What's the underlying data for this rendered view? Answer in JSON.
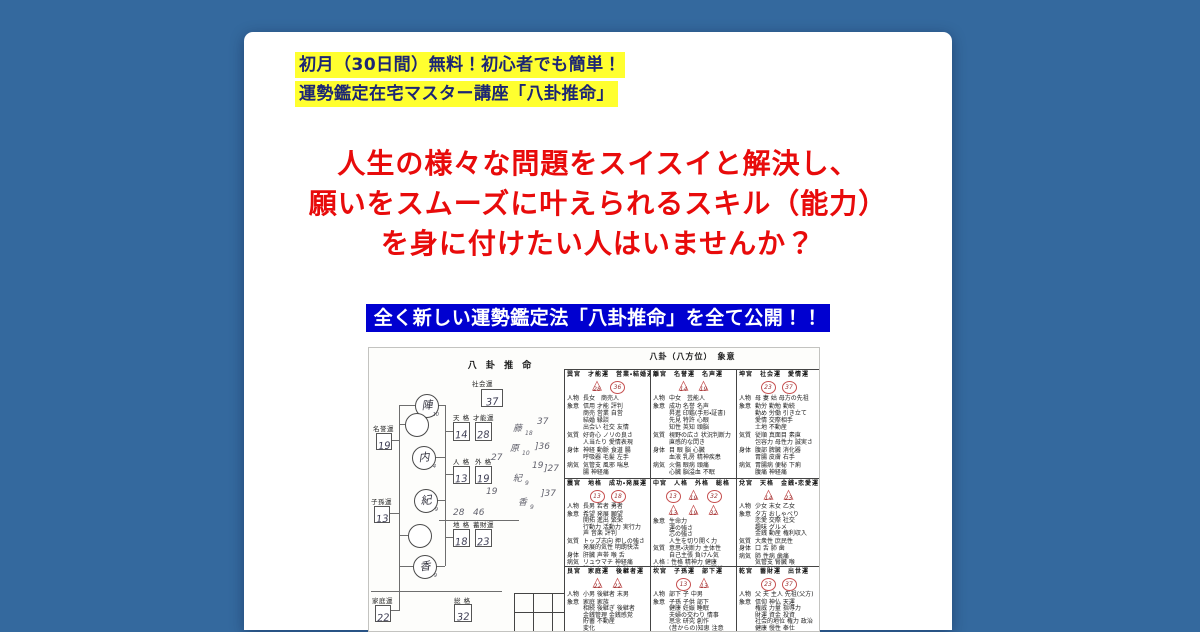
{
  "canvas": {
    "bg": "#34699e",
    "card_bg": "#ffffff"
  },
  "promo": {
    "bg": "#ffff2f",
    "color": "#1c2674",
    "lines": [
      "初月（30日間）無料！初心者でも簡単！",
      "運勢鑑定在宅マスター講座「八卦推命」"
    ]
  },
  "headline": {
    "color": "#e80b0b",
    "lines": [
      "人生の様々な問題をスイスイと解決し、",
      "願いをスムーズに叶えられるスキル（能力）",
      "を身に付けたい人はいませんか？"
    ]
  },
  "banner": {
    "bg": "#0000d0",
    "color": "#ffffff",
    "text": "全く新しい運勢鑑定法「八卦推命」を全て公開！！"
  },
  "scan": {
    "diagram": {
      "title": "八 卦 推 命",
      "circles": [
        {
          "char": "陣",
          "strokes": "10",
          "x": 46,
          "y": 46
        },
        {
          "char": "",
          "strokes": "",
          "x": 36,
          "y": 65
        },
        {
          "char": "内",
          "strokes": "4",
          "x": 43,
          "y": 98
        },
        {
          "char": "紀",
          "strokes": "9",
          "x": 45,
          "y": 141
        },
        {
          "char": "",
          "strokes": "",
          "x": 39,
          "y": 176
        },
        {
          "char": "香",
          "strokes": "9",
          "x": 44,
          "y": 207
        }
      ],
      "scores": [
        {
          "label": "社会運",
          "value": "37",
          "lx": 103,
          "ly": 30,
          "bx": 112,
          "by": 41,
          "bw": 20,
          "bh": 16
        },
        {
          "label": "天 格",
          "value": "14",
          "lx": 84,
          "ly": 64,
          "bx": 84,
          "by": 74,
          "bw": 15,
          "bh": 17
        },
        {
          "label": "才能運",
          "value": "28",
          "lx": 104,
          "ly": 64,
          "bx": 106,
          "by": 74,
          "bw": 15,
          "bh": 17
        },
        {
          "label": "名誉運",
          "value": "19",
          "lx": 4,
          "ly": 75,
          "bx": 7,
          "by": 85,
          "bw": 14,
          "bh": 15
        },
        {
          "label": "人 格",
          "value": "13",
          "lx": 84,
          "ly": 108,
          "bx": 84,
          "by": 118,
          "bw": 15,
          "bh": 16
        },
        {
          "label": "外 格",
          "value": "19",
          "lx": 106,
          "ly": 108,
          "bx": 106,
          "by": 118,
          "bw": 15,
          "bh": 16
        },
        {
          "label": "子孫運",
          "value": "13",
          "lx": 2,
          "ly": 148,
          "bx": 5,
          "by": 158,
          "bw": 14,
          "bh": 15
        },
        {
          "label": "地 格",
          "value": "18",
          "lx": 84,
          "ly": 171,
          "bx": 84,
          "by": 181,
          "bw": 15,
          "bh": 16
        },
        {
          "label": "蓄財運",
          "value": "23",
          "lx": 104,
          "ly": 171,
          "bx": 106,
          "by": 181,
          "bw": 15,
          "bh": 16
        },
        {
          "label": "家庭運",
          "value": "22",
          "lx": 3,
          "ly": 247,
          "bx": 6,
          "by": 257,
          "bw": 14,
          "bh": 15
        },
        {
          "label": "総 格",
          "value": "32",
          "lx": 85,
          "ly": 247,
          "bx": 85,
          "by": 256,
          "bw": 16,
          "bh": 16
        }
      ],
      "lines": [
        {
          "x": 30,
          "y": 57,
          "w": 1,
          "h": 162
        },
        {
          "x": 30,
          "y": 57,
          "w": 16,
          "h": 1
        },
        {
          "x": 30,
          "y": 76,
          "w": 6,
          "h": 1
        },
        {
          "x": 30,
          "y": 187,
          "w": 9,
          "h": 1
        },
        {
          "x": 30,
          "y": 218,
          "w": 14,
          "h": 1
        },
        {
          "x": 21,
          "y": 92,
          "w": 9,
          "h": 1
        },
        {
          "x": 19,
          "y": 165,
          "w": 11,
          "h": 1
        },
        {
          "x": 30,
          "y": 218,
          "w": 1,
          "h": 45
        },
        {
          "x": 20,
          "y": 262,
          "w": 10,
          "h": 1
        },
        {
          "x": 76,
          "y": 57,
          "w": 1,
          "h": 161
        },
        {
          "x": 68,
          "y": 57,
          "w": 8,
          "h": 1
        },
        {
          "x": 66,
          "y": 109,
          "w": 10,
          "h": 1
        },
        {
          "x": 67,
          "y": 152,
          "w": 9,
          "h": 1
        },
        {
          "x": 66,
          "y": 218,
          "w": 10,
          "h": 1
        },
        {
          "x": 76,
          "y": 83,
          "w": 8,
          "h": 1
        },
        {
          "x": 76,
          "y": 126,
          "w": 8,
          "h": 1
        },
        {
          "x": 76,
          "y": 189,
          "w": 8,
          "h": 1
        },
        {
          "x": 2,
          "y": 243,
          "w": 131,
          "h": 1
        },
        {
          "x": 70,
          "y": 172,
          "w": 80,
          "h": 1
        }
      ],
      "handnote": [
        {
          "t": "37",
          "x": 168,
          "y": 70
        },
        {
          "t": "藤",
          "x": 144,
          "y": 77
        },
        {
          "t": "18",
          "x": 156,
          "y": 83,
          "s": 1
        },
        {
          "t": "]36",
          "x": 166,
          "y": 95
        },
        {
          "t": "原",
          "x": 141,
          "y": 97
        },
        {
          "t": "10",
          "x": 153,
          "y": 103,
          "s": 1
        },
        {
          "t": "27",
          "x": 122,
          "y": 106
        },
        {
          "t": "19",
          "x": 163,
          "y": 114
        },
        {
          "t": "]27",
          "x": 175,
          "y": 117
        },
        {
          "t": "紀",
          "x": 144,
          "y": 127
        },
        {
          "t": "9",
          "x": 156,
          "y": 133,
          "s": 1
        },
        {
          "t": "19",
          "x": 117,
          "y": 140
        },
        {
          "t": "]37",
          "x": 172,
          "y": 142
        },
        {
          "t": "香",
          "x": 149,
          "y": 151
        },
        {
          "t": "9",
          "x": 161,
          "y": 157,
          "s": 1
        },
        {
          "t": "28",
          "x": 84,
          "y": 161
        },
        {
          "t": "46",
          "x": 104,
          "y": 161
        }
      ],
      "grid": {
        "x": 145,
        "y": 245,
        "cell": 19,
        "rows": 3,
        "cols": 3
      }
    },
    "table": {
      "title": "八卦（八方位）　象意",
      "row_heights": [
        108,
        87,
        90
      ],
      "col_widths": [
        85,
        86,
        84
      ],
      "rows": [
        [
          {
            "palace": "巽宮",
            "fortunes": "才能運　営業・結婚運",
            "marks": [
              {
                "shape": "tri",
                "n": "28"
              },
              {
                "shape": "circ",
                "n": "36"
              }
            ],
            "entries": [
              {
                "label": "人物",
                "text": "長女　商売人"
              },
              {
                "label": "象意",
                "text": "信用 才能 評判\n商売 営業 自営\n結婚 縁談\n出会い 社交 友情"
              },
              {
                "label": "気質",
                "text": "好奇心 ノリの良さ\n人当たり 愛情表現"
              },
              {
                "label": "身体",
                "text": "神経 動脈 食道 腸\n呼吸器 毛髪 左手"
              },
              {
                "label": "病気",
                "text": "気管支 風邪 喘息\n腸 神経痛"
              }
            ]
          },
          {
            "palace": "離宮",
            "fortunes": "名誉運　名声運",
            "marks": [
              {
                "shape": "tri",
                "n": "14"
              },
              {
                "shape": "tri",
                "n": "19"
              }
            ],
            "entries": [
              {
                "label": "人物",
                "text": "中女　芸能人"
              },
              {
                "label": "象意",
                "text": "成功 名誉 名声\n昇進 印鑑(手形・証書)\n先見 特許 心眼\n知性 英知 頭脳"
              },
              {
                "label": "気質",
                "text": "視野の広さ 状況判断力\n直感的な閃き"
              },
              {
                "label": "身体",
                "text": "目 眼 脳 心臓\n血液 乳房 精神疾患"
              },
              {
                "label": "病気",
                "text": "火傷 眼病 頭痛\n心臓 脳溢血 不眠"
              }
            ]
          },
          {
            "palace": "坤宮",
            "fortunes": "社会運　愛情運",
            "marks": [
              {
                "shape": "circ",
                "n": "23"
              },
              {
                "shape": "circ",
                "n": "37"
              }
            ],
            "entries": [
              {
                "label": "人物",
                "text": "母 妻 姑 母方の先祖"
              },
              {
                "label": "象意",
                "text": "勤労 勤勉 勤続\n勤め 労働 引き立て\n愛情 交際相手\n土地 不動産"
              },
              {
                "label": "気質",
                "text": "従順 真面目 素直\n包容力 母性力 誠実さ"
              },
              {
                "label": "身体",
                "text": "腹部 脾臓 消化器\n胃腸 皮膚 右手"
              },
              {
                "label": "病気",
                "text": "胃腸病 便秘 下痢\n腹痛 神経痛"
              }
            ]
          }
        ],
        [
          {
            "palace": "震宮",
            "fortunes": "地格　成功・発展運",
            "marks": [
              {
                "shape": "circ",
                "n": "13"
              },
              {
                "shape": "circ",
                "n": "18"
              }
            ],
            "entries": [
              {
                "label": "人物",
                "text": "長男 若者 勇者"
              },
              {
                "label": "象意",
                "text": "希望 発展 願望\n開拓 進出 繁栄\n行動力 活動力 実行力\n声 音楽 評判"
              },
              {
                "label": "気質",
                "text": "トップ志向 押しの強さ\n発展的気性 明朗快活"
              },
              {
                "label": "身体",
                "text": "肝臓 声帯 喉 舌"
              },
              {
                "label": "病気",
                "text": "リュウマチ 神経痛\n脱毛 高血圧 肝臓"
              }
            ]
          },
          {
            "palace": "中宮",
            "fortunes": "人格　外格　総格",
            "narrow": true,
            "marks": [
              {
                "shape": "circ",
                "n": "13"
              },
              {
                "shape": "tri",
                "n": "19"
              },
              {
                "shape": "circ",
                "n": "32"
              },
              {
                "shape": "tri",
                "n": "13"
              },
              {
                "shape": "tri",
                "n": "19"
              },
              {
                "shape": "tri",
                "n": "32"
              }
            ],
            "entries": [
              {
                "label": "象意",
                "text": "生命力\n運の強さ\n芯の強さ\n人生を切り開く力"
              },
              {
                "label": "気質",
                "text": "意思・決断力 主体性\n自己主張 負けん気"
              },
              {
                "label": "",
                "text": "人格：性格 精神力 健康\n外格：外見 印象 対人関係\n総格：頑張る力 生命力"
              }
            ]
          },
          {
            "palace": "兌宮",
            "fortunes": "天格　金銭・恋愛運",
            "marks": [
              {
                "shape": "tri",
                "n": "14"
              },
              {
                "shape": "tri",
                "n": "23"
              }
            ],
            "entries": [
              {
                "label": "人物",
                "text": "少女 末女 乙女"
              },
              {
                "label": "象意",
                "text": "夕方 おしゃべり\n恋愛 交際 社交\n趣味 グルメ\n金銭 動産 権利収入"
              },
              {
                "label": "気質",
                "text": "大衆性 庶民性"
              },
              {
                "label": "身体",
                "text": "口 舌 肺 歯"
              },
              {
                "label": "病気",
                "text": "肺 性病 歯痛\n気管支 腎臓 喉"
              }
            ]
          }
        ],
        [
          {
            "palace": "艮宮",
            "fortunes": "家庭運　後継者運",
            "marks": [
              {
                "shape": "tri",
                "n": "22"
              },
              {
                "shape": "tri",
                "n": "22"
              }
            ],
            "entries": [
              {
                "label": "人物",
                "text": "小男 後継者 末男"
              },
              {
                "label": "象意",
                "text": "家庭 家族\n相続 後継ぎ 後継者\n金銭管理 金銭感覚\n貯蓄 不動産\n変化"
              },
              {
                "label": "気質",
                "text": "家庭・身内に対する愛情"
              }
            ]
          },
          {
            "palace": "坎宮",
            "fortunes": "子孫運　部下運",
            "marks": [
              {
                "shape": "circ",
                "n": "13"
              },
              {
                "shape": "tri",
                "n": "13"
              }
            ],
            "entries": [
              {
                "label": "人物",
                "text": "部下 子 中男"
              },
              {
                "label": "象意",
                "text": "子孫 子供 部下\n健康 妊娠 睡眠\n夫婦の交わり 情事\n思念 研究 創作\n(昔からの)知恵 注意"
              },
              {
                "label": "気質",
                "text": "思慮深さ もの思い"
              }
            ]
          },
          {
            "palace": "乾宮",
            "fortunes": "蓄財運　出世運",
            "marks": [
              {
                "shape": "circ",
                "n": "23"
              },
              {
                "shape": "circ",
                "n": "37"
              }
            ],
            "entries": [
              {
                "label": "人物",
                "text": "父 夫 主人 先祖(父方)"
              },
              {
                "label": "象意",
                "text": "信仰 神仏 天運\n権威 力量 指導力\n財運 資金 投資\n社会的地位 権力 政治\n健康 慢性 奉仕"
              },
              {
                "label": "気質",
                "text": "剛健 生命力 自信"
              }
            ]
          }
        ]
      ]
    }
  }
}
